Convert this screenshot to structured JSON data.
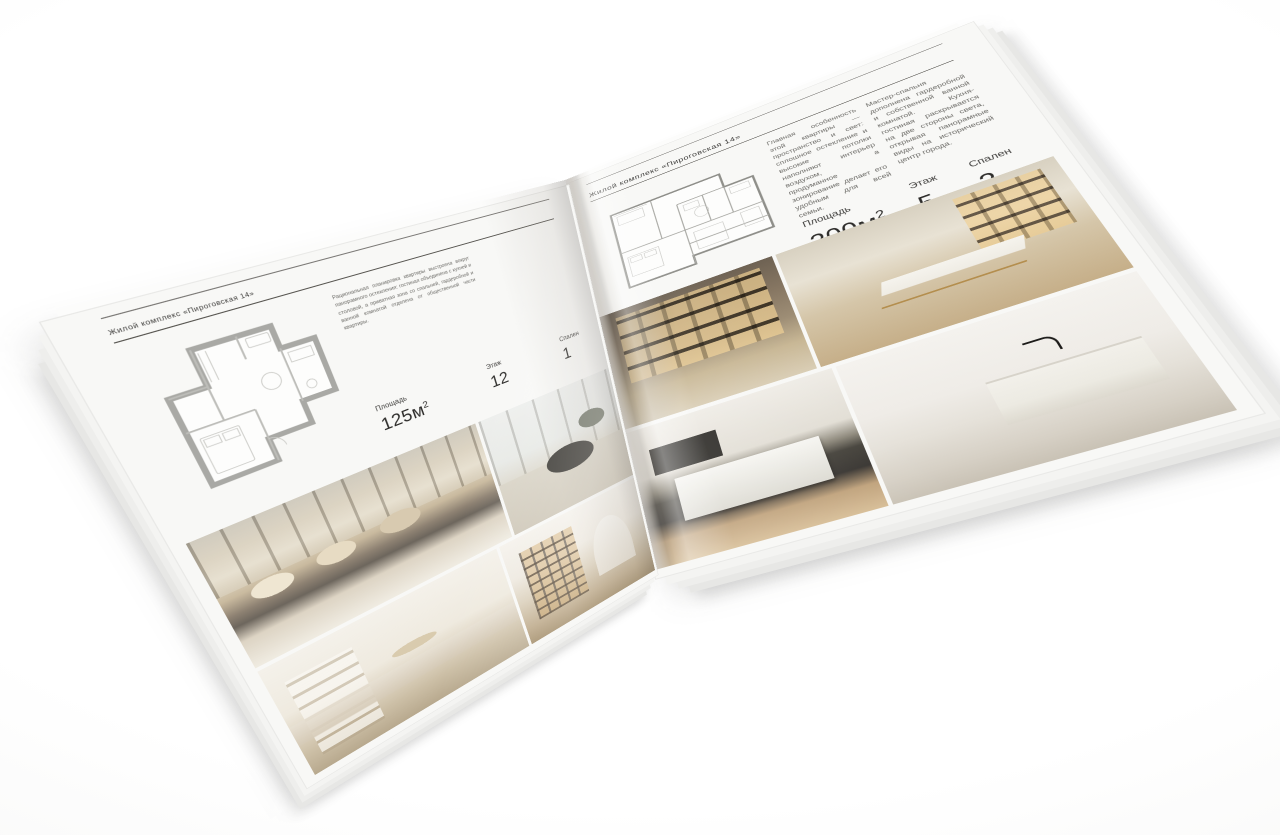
{
  "brochure": {
    "left_page": {
      "caption": "Жилой комплекс «Пироговская 14»",
      "description": "Рациональная планировка квартиры выстроена вокруг панорамного остекления: гостиная объединена с кухней и столовой, а приватная зона со спальней, гардеробной и ванной комнатой отделена от общественной части квартиры.",
      "stats": [
        {
          "label": "Площадь",
          "value": "125м",
          "sup": "2"
        },
        {
          "label": "Этаж",
          "value": "12",
          "sup": ""
        },
        {
          "label": "Спален",
          "value": "1",
          "sup": ""
        }
      ],
      "photos": [
        "bedroom-panorama",
        "lounge-armchair-window",
        "bedroom-wardrobe-shelves",
        "hallway-bookshelf"
      ]
    },
    "right_page": {
      "caption": "Жилой комплекс «Пироговская 14»",
      "description_1": "Главная особенность этой квартиры — пространство и свет: сплошное остекление и высокие потолки наполняют интерьер воздухом, а продуманное зонирование делает его удобным для всей семьи.",
      "description_2": "Мастер-спальня дополнена гардеробной и собственной ванной комнатой. Кухня-гостиная раскрывается на две стороны света, открывая панорамные виды на исторический центр города.",
      "stats": [
        {
          "label": "Площадь",
          "value": "200м",
          "sup": "2"
        },
        {
          "label": "Этаж",
          "value": "5",
          "sup": ""
        },
        {
          "label": "Спален",
          "value": "2",
          "sup": ""
        }
      ],
      "photos": [
        "wardrobe-lit-shelving",
        "study-desk-gold-legs",
        "kitchen-island",
        "bathroom-marble-vanity"
      ]
    },
    "colors": {
      "page": "#fcfcfb",
      "rule": "#56544f",
      "body_text": "#6b6a66",
      "stat_text": "#2e2d2b",
      "plan_wall_left": "#a9a9a5",
      "plan_wall_right": "#8f8f8a",
      "photo_beige": "#d8cab0",
      "photo_taupe": "#8d8172",
      "photo_charcoal": "#3e3c37",
      "photo_gold": "#c9a35f"
    }
  }
}
